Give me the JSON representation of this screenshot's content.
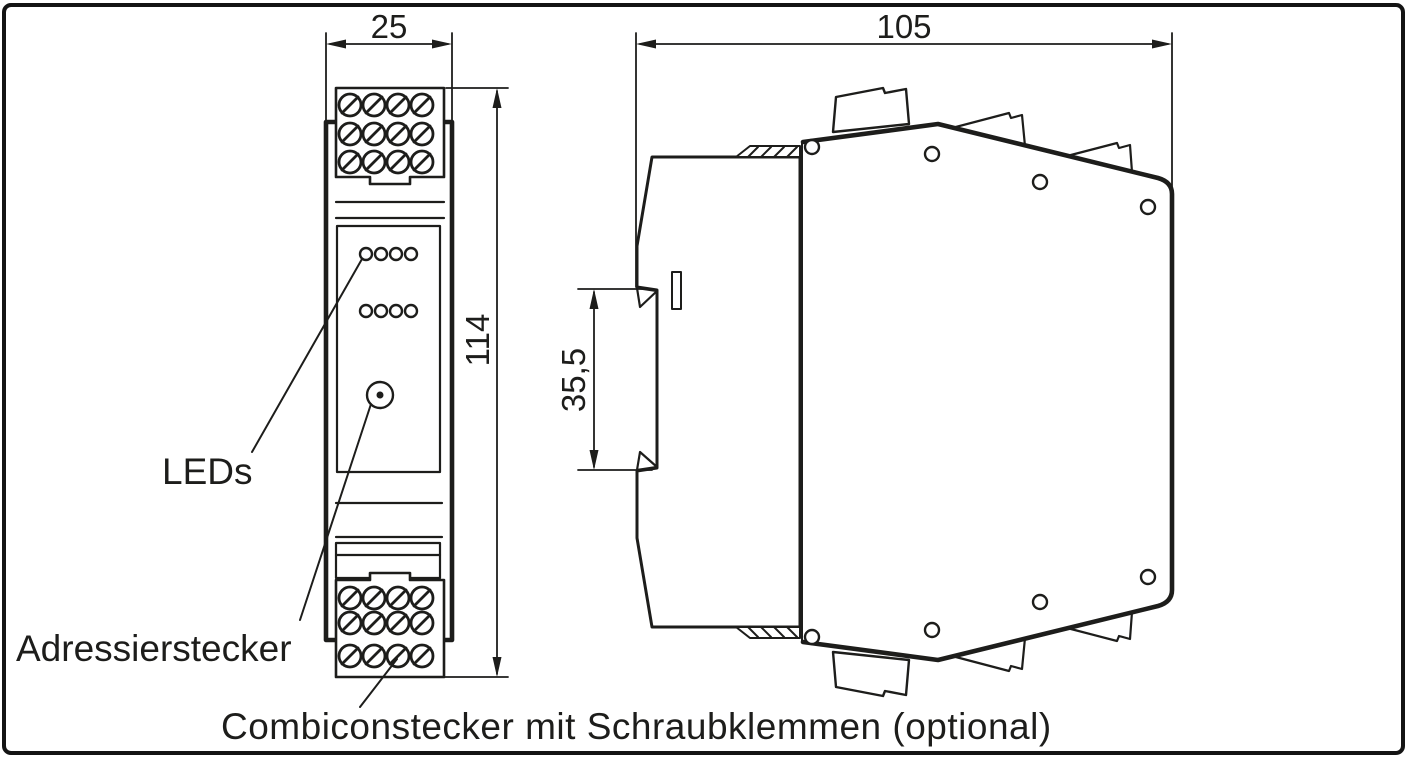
{
  "page": {
    "background": "#ffffff",
    "line_color": "#1d1d1b"
  },
  "dimensions": {
    "front_width": "25",
    "side_width": "105",
    "front_height": "114",
    "din_rail_height": "35,5"
  },
  "annotations": {
    "leds": "LEDs",
    "addressing_connector": "Adressierstecker",
    "combicon": "Combiconstecker mit Schraubklemmen (optional)"
  }
}
